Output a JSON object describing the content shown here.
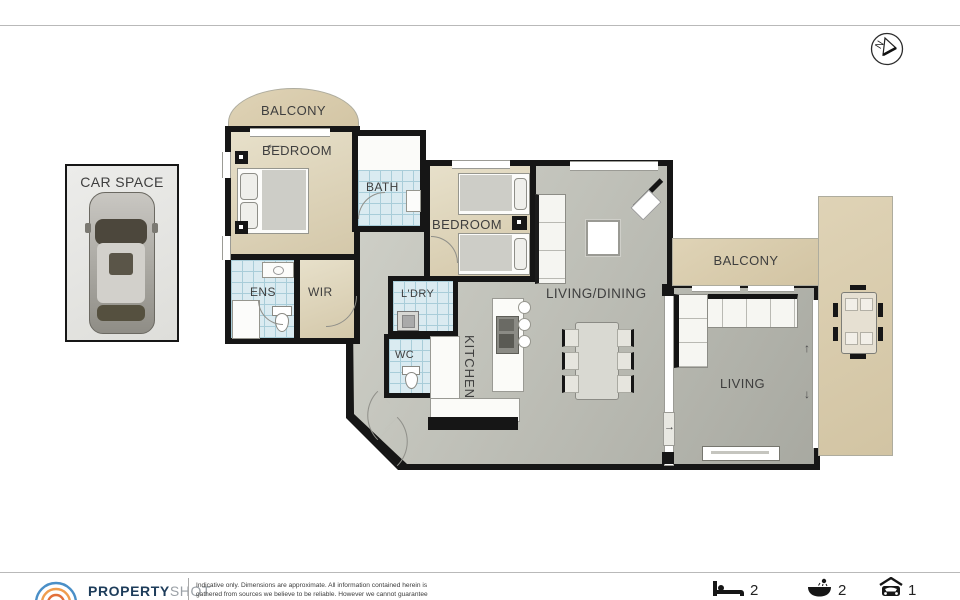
{
  "compass": {
    "letter": "N"
  },
  "car_space": {
    "label": "CAR SPACE"
  },
  "rooms": {
    "balcony_top": "BALCONY",
    "bedroom_main": "BEDROOM",
    "ens": "ENS",
    "wir": "WIR",
    "bath": "BATH",
    "bedroom_second": "BEDROOM",
    "laundry": "L'DRY",
    "wc": "WC",
    "kitchen": "KITCHEN",
    "living_dining": "LIVING/DINING",
    "balcony_right": "BALCONY",
    "living": "LIVING"
  },
  "icons": {
    "arrow_left": "←",
    "arrow_up": "↑",
    "arrow_down": "↓",
    "arrow_right": "→"
  },
  "footer": {
    "brand_bold": "PROPERTY",
    "brand_light": "SHOT",
    "disclaimer_line1": "Indicative only.  Dimensions are approximate.  All information contained herein is",
    "disclaimer_line2": "gathered from sources we believe to be reliable.  However we cannot guarantee",
    "stats": {
      "beds": "2",
      "baths": "2",
      "cars": "1"
    }
  },
  "colors": {
    "floor_beige": "#ded5bc",
    "balcony_tan": "#d9cbab",
    "carpet_gray": "#b9b9b1",
    "tile_blue": "#d8e9ef",
    "wall_black": "#161616",
    "brand_navy": "#1d3c5a",
    "brand_gray": "#9aa0a6",
    "logo_blue": "#4a8fc7",
    "logo_orange": "#ef9d4e"
  }
}
